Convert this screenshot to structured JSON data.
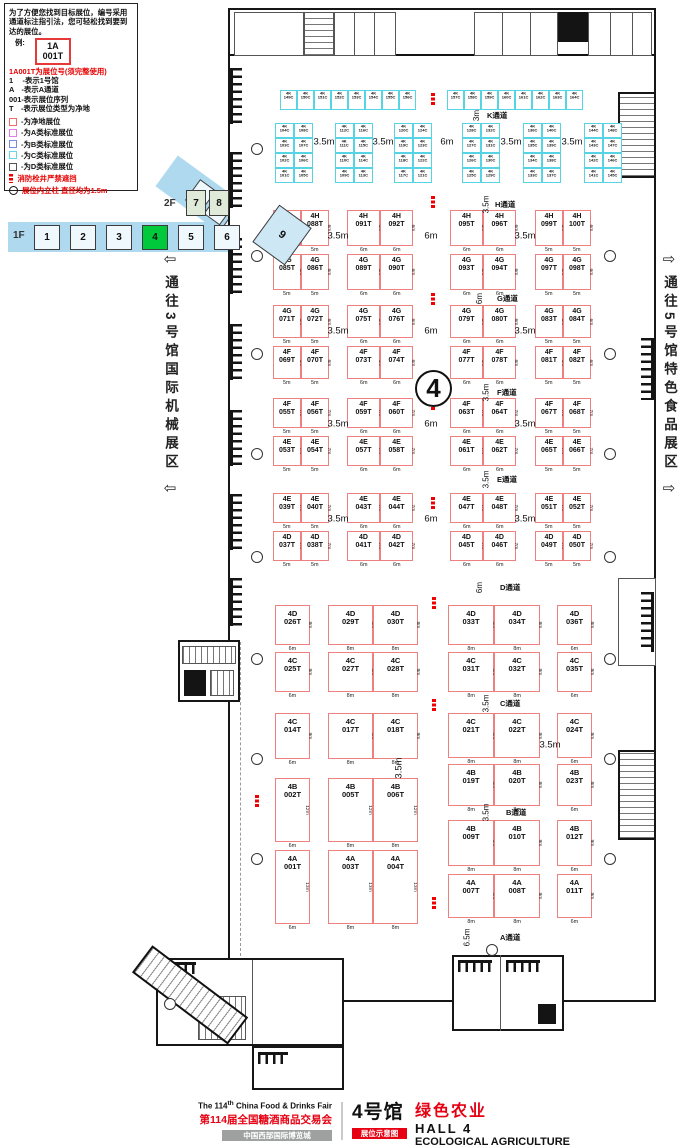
{
  "legend": {
    "intro": "为了方便您找到目标展位，编号采用通道标注指引法，您可轻松找到要到达的展位。",
    "example_label": "例:",
    "example_booth_line1": "1A",
    "example_booth_line2": "001T",
    "code_note": "1A001T为展位号(须完整使用)",
    "code_lines": [
      "1　 -表示1号馆",
      "A　-表示A通道",
      "001-表示展位序列",
      "T　-表示展位类型为净地"
    ],
    "swatches": [
      {
        "color": "#f26a6a",
        "label": "-为净地展位"
      },
      {
        "color": "#e878e8",
        "label": "-为A类标准展位"
      },
      {
        "color": "#7a86e8",
        "label": "-为B类标准展位"
      },
      {
        "color": "#62d8e8",
        "label": "-为C类标准展位"
      },
      {
        "color": "#555555",
        "label": "-为D类标准展位"
      }
    ],
    "fire_note": "消防栓井严禁遮挡",
    "column_note": "展位内立柱 直径均为1.5m"
  },
  "minimap": {
    "floor2": "2F",
    "floor2_halls": [
      "7",
      "8"
    ],
    "floor1": "1F",
    "floor1_halls": [
      "1",
      "2",
      "3",
      "4",
      "5",
      "6"
    ],
    "current_hall": "4",
    "wing_hall": "9",
    "wing_halls": [
      "10",
      "11",
      "12",
      "13",
      "14"
    ],
    "wing2_halls": [
      "15",
      "16"
    ],
    "highlight_color": "#00c93c",
    "floor1_color": "#aed9ef",
    "floor2_color": "#dfead9"
  },
  "arrows": {
    "left_glyph": "⇦",
    "left_text": "通往3号馆国际机械展区",
    "right_glyph": "⇨",
    "right_text": "通往5号馆特色食品展区"
  },
  "hall_marker": "4",
  "aisles": [
    {
      "name": "K通道",
      "width": "3m"
    },
    {
      "name": "H通道",
      "width": "3.5m"
    },
    {
      "name": "G通道",
      "width": "6m"
    },
    {
      "name": "F通道",
      "width": "3.5m"
    },
    {
      "name": "E通道",
      "width": "3.5m"
    },
    {
      "name": "D通道",
      "width": "6m"
    },
    {
      "name": "C通道",
      "width": "3.5m"
    },
    {
      "name": "B通道",
      "width": "3.5m"
    },
    {
      "name": "A通道",
      "width": "6.5m"
    }
  ],
  "dims": {
    "cell_widths": [
      "5m",
      "5m",
      "6m",
      "6m",
      "6m",
      "6m",
      "5m",
      "5m"
    ],
    "row_gaps": [
      "3.5m",
      "6m",
      "3.5m"
    ],
    "k_gaps": [
      "3.5m",
      "3.5m",
      "6m",
      "3.5m",
      "3.5m"
    ],
    "cb_gap": "3.5m",
    "left_gap": "3.5m"
  },
  "booths": {
    "k": {
      "prefix": "4K",
      "strip": [
        "149C",
        "150C",
        "151C",
        "152C",
        "153C",
        "154C",
        "155C",
        "156C",
        "157C",
        "158C",
        "159C",
        "160C",
        "161C",
        "162C",
        "163C",
        "164C"
      ],
      "groups": [
        [
          "104C",
          "108C",
          "103C",
          "107C",
          "102C",
          "106C",
          "101C",
          "105C"
        ],
        [
          "112C",
          "116C",
          "111C",
          "115C",
          "110C",
          "114C",
          "109C",
          "113C"
        ],
        [
          "120C",
          "124C",
          "119C",
          "123C",
          "118C",
          "122C",
          "117C",
          "121C"
        ],
        [
          "128C",
          "132C",
          "127C",
          "131C",
          "126C",
          "130C",
          "125C",
          "129C"
        ],
        [
          "136C",
          "140C",
          "135C",
          "139C",
          "134C",
          "138C",
          "133C",
          "137C"
        ],
        [
          "144C",
          "148C",
          "143C",
          "147C",
          "142C",
          "146C",
          "141C",
          "145C"
        ]
      ]
    },
    "rows": [
      {
        "id": "HG",
        "top": [
          "4H 087T",
          "4H 088T",
          "4H 091T",
          "4H 092T",
          "4H 095T",
          "4H 096T",
          "4H 099T",
          "4H 100T"
        ],
        "bottom": [
          "4G 085T",
          "4G 086T",
          "4G 089T",
          "4G 090T",
          "4G 093T",
          "4G 094T",
          "4G 097T",
          "4G 098T"
        ],
        "side": "6m"
      },
      {
        "id": "GF",
        "top": [
          "4G 071T",
          "4G 072T",
          "4G 075T",
          "4G 076T",
          "4G 079T",
          "4G 080T",
          "4G 083T",
          "4G 084T"
        ],
        "bottom": [
          "4F 069T",
          "4F 070T",
          "4F 073T",
          "4F 074T",
          "4F 077T",
          "4F 078T",
          "4F 081T",
          "4F 082T"
        ],
        "side": "6m"
      },
      {
        "id": "FE",
        "top": [
          "4F 055T",
          "4F 056T",
          "4F 059T",
          "4F 060T",
          "4F 063T",
          "4F 064T",
          "4F 067T",
          "4F 068T"
        ],
        "bottom": [
          "4E 053T",
          "4E 054T",
          "4E 057T",
          "4E 058T",
          "4E 061T",
          "4E 062T",
          "4E 065T",
          "4E 066T"
        ],
        "side": "7m"
      },
      {
        "id": "ED",
        "top": [
          "4E 039T",
          "4E 040T",
          "4E 043T",
          "4E 044T",
          "4E 047T",
          "4E 048T",
          "4E 051T",
          "4E 052T"
        ],
        "bottom": [
          "4D 037T",
          "4D 038T",
          "4D 041T",
          "4D 042T",
          "4D 045T",
          "4D 046T",
          "4D 049T",
          "4D 050T"
        ],
        "side": "7m"
      }
    ],
    "dc": {
      "top": [
        "4D 026T",
        "4D 029T",
        "4D 030T",
        "4D 033T",
        "4D 034T",
        "4D 036T"
      ],
      "bottom": [
        "4C 025T",
        "4C 027T",
        "4C 028T",
        "4C 031T",
        "4C 032T",
        "4C 035T"
      ],
      "widths": [
        "6m",
        "8m",
        "8m",
        "8m",
        "8m",
        "6m"
      ],
      "side": "8m"
    },
    "lower_left": {
      "c": [
        "4C 014T",
        "4C 017T",
        "4C 018T"
      ],
      "b": [
        "4B 002T",
        "4B 005T",
        "4B 006T"
      ],
      "a": [
        "4A 001T",
        "4A 003T",
        "4A 004T"
      ],
      "widths": [
        "6m",
        "8m",
        "8m"
      ],
      "c_side": "9m",
      "b_side": "12m",
      "a_side": "13m"
    },
    "lower_right": {
      "c": [
        "4C 021T",
        "4C 022T",
        "4C 024T"
      ],
      "b1": [
        "4B 019T",
        "4B 020T",
        "4B 023T"
      ],
      "b2": [
        "4B 009T",
        "4B 010T",
        "4B 012T"
      ],
      "a": [
        "4A 007T",
        "4A 008T",
        "4A 011T"
      ],
      "widths": [
        "8m",
        "8m",
        "6m"
      ],
      "c_side": "8m",
      "b1_side": "8m",
      "b2_side": "9m",
      "a_side": "9m"
    }
  },
  "footer": {
    "en_title_prefix": "The 114",
    "en_title_sup": "th",
    "en_title_rest": " China Food & Drinks Fair",
    "cn_title": "第114届全国糖酒商品交易会",
    "venue": "中国西部国际博览城",
    "hall_cn": "4号馆",
    "hall_theme": "绿色农业",
    "hall_en": "HALL 4",
    "badge": "展位示意图",
    "theme_en": "ECOLOGICAL AGRICULTURE"
  }
}
